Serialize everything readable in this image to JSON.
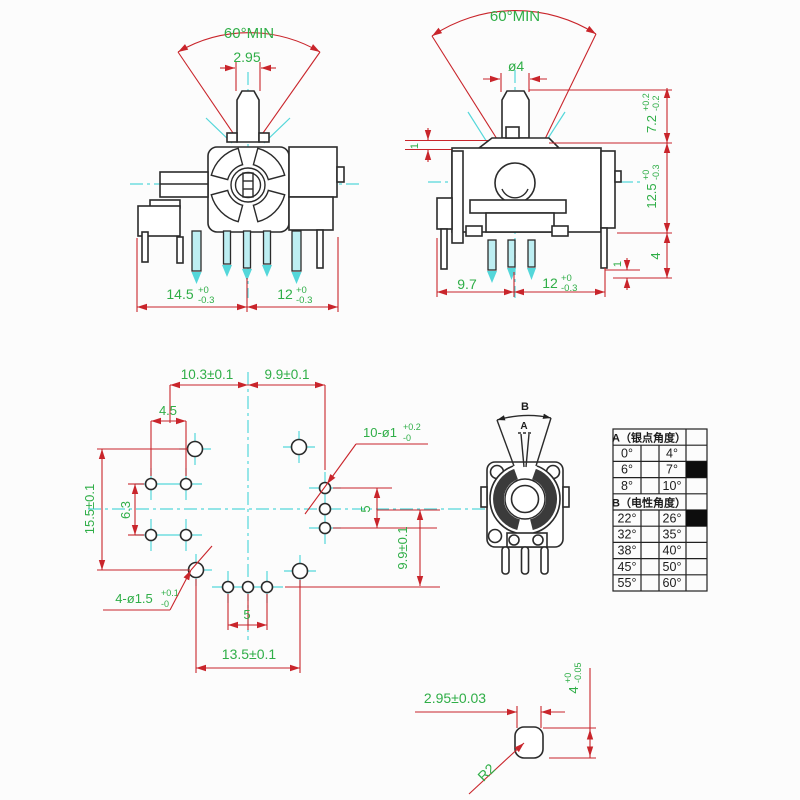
{
  "front_view": {
    "angle": "60°MIN",
    "shaft_width": "2.95",
    "dim_left": {
      "main": "14.5",
      "sup": "+0",
      "sub": "-0.3"
    },
    "dim_right": {
      "main": "12",
      "sup": "+0",
      "sub": "-0.3"
    }
  },
  "side_view": {
    "angle": "60°MIN",
    "shaft_dia": "ø4",
    "step_top": "1",
    "height_upper": {
      "main": "7.2",
      "sup": "+0.2",
      "sub": "-0.2"
    },
    "height_body": {
      "main": "12.5",
      "sup": "+0",
      "sub": "-0.3"
    },
    "pin_length": "4",
    "step_right": "1",
    "base_left": "9.7",
    "base_right": {
      "main": "12",
      "sup": "+0",
      "sub": "-0.3"
    }
  },
  "pcb_layout": {
    "spacing_left": "10.3±0.1",
    "spacing_right": "9.9±0.1",
    "pair_spacing": "4.5",
    "height": "15.5±0.1",
    "row_gap": "6.3",
    "small_hole_label": {
      "main": "10-ø1",
      "sup": "+0.2",
      "sub": "-0"
    },
    "right_pitch": "5",
    "right_height": "9.9±0.1",
    "large_hole_label": {
      "main": "4-ø1.5",
      "sup": "+0.1",
      "sub": "-0"
    },
    "bottom_pitch": "5",
    "width": "13.5±0.1"
  },
  "top_view": {
    "label_a": "A",
    "label_b": "B"
  },
  "angle_table": {
    "header_a": "A（银点角度）",
    "header_b": "B（电性角度）",
    "rows_a": [
      [
        "0°",
        "4°"
      ],
      [
        "6°",
        "7°"
      ],
      [
        "8°",
        "10°"
      ]
    ],
    "rows_b": [
      [
        "22°",
        "26°"
      ],
      [
        "32°",
        "35°"
      ],
      [
        "38°",
        "40°"
      ],
      [
        "45°",
        "50°"
      ],
      [
        "55°",
        "60°"
      ]
    ],
    "marked": [
      "7°",
      "26°"
    ]
  },
  "shaft_detail": {
    "width": "2.95±0.03",
    "height": {
      "main": "4",
      "sup": "+0",
      "sub": "-0.05"
    },
    "radius": "R2"
  },
  "colors": {
    "dimension_red": "#c9252b",
    "label_green": "#2fae47",
    "centerline_cyan": "#54d7da",
    "outline_black": "#2b2b2b"
  }
}
